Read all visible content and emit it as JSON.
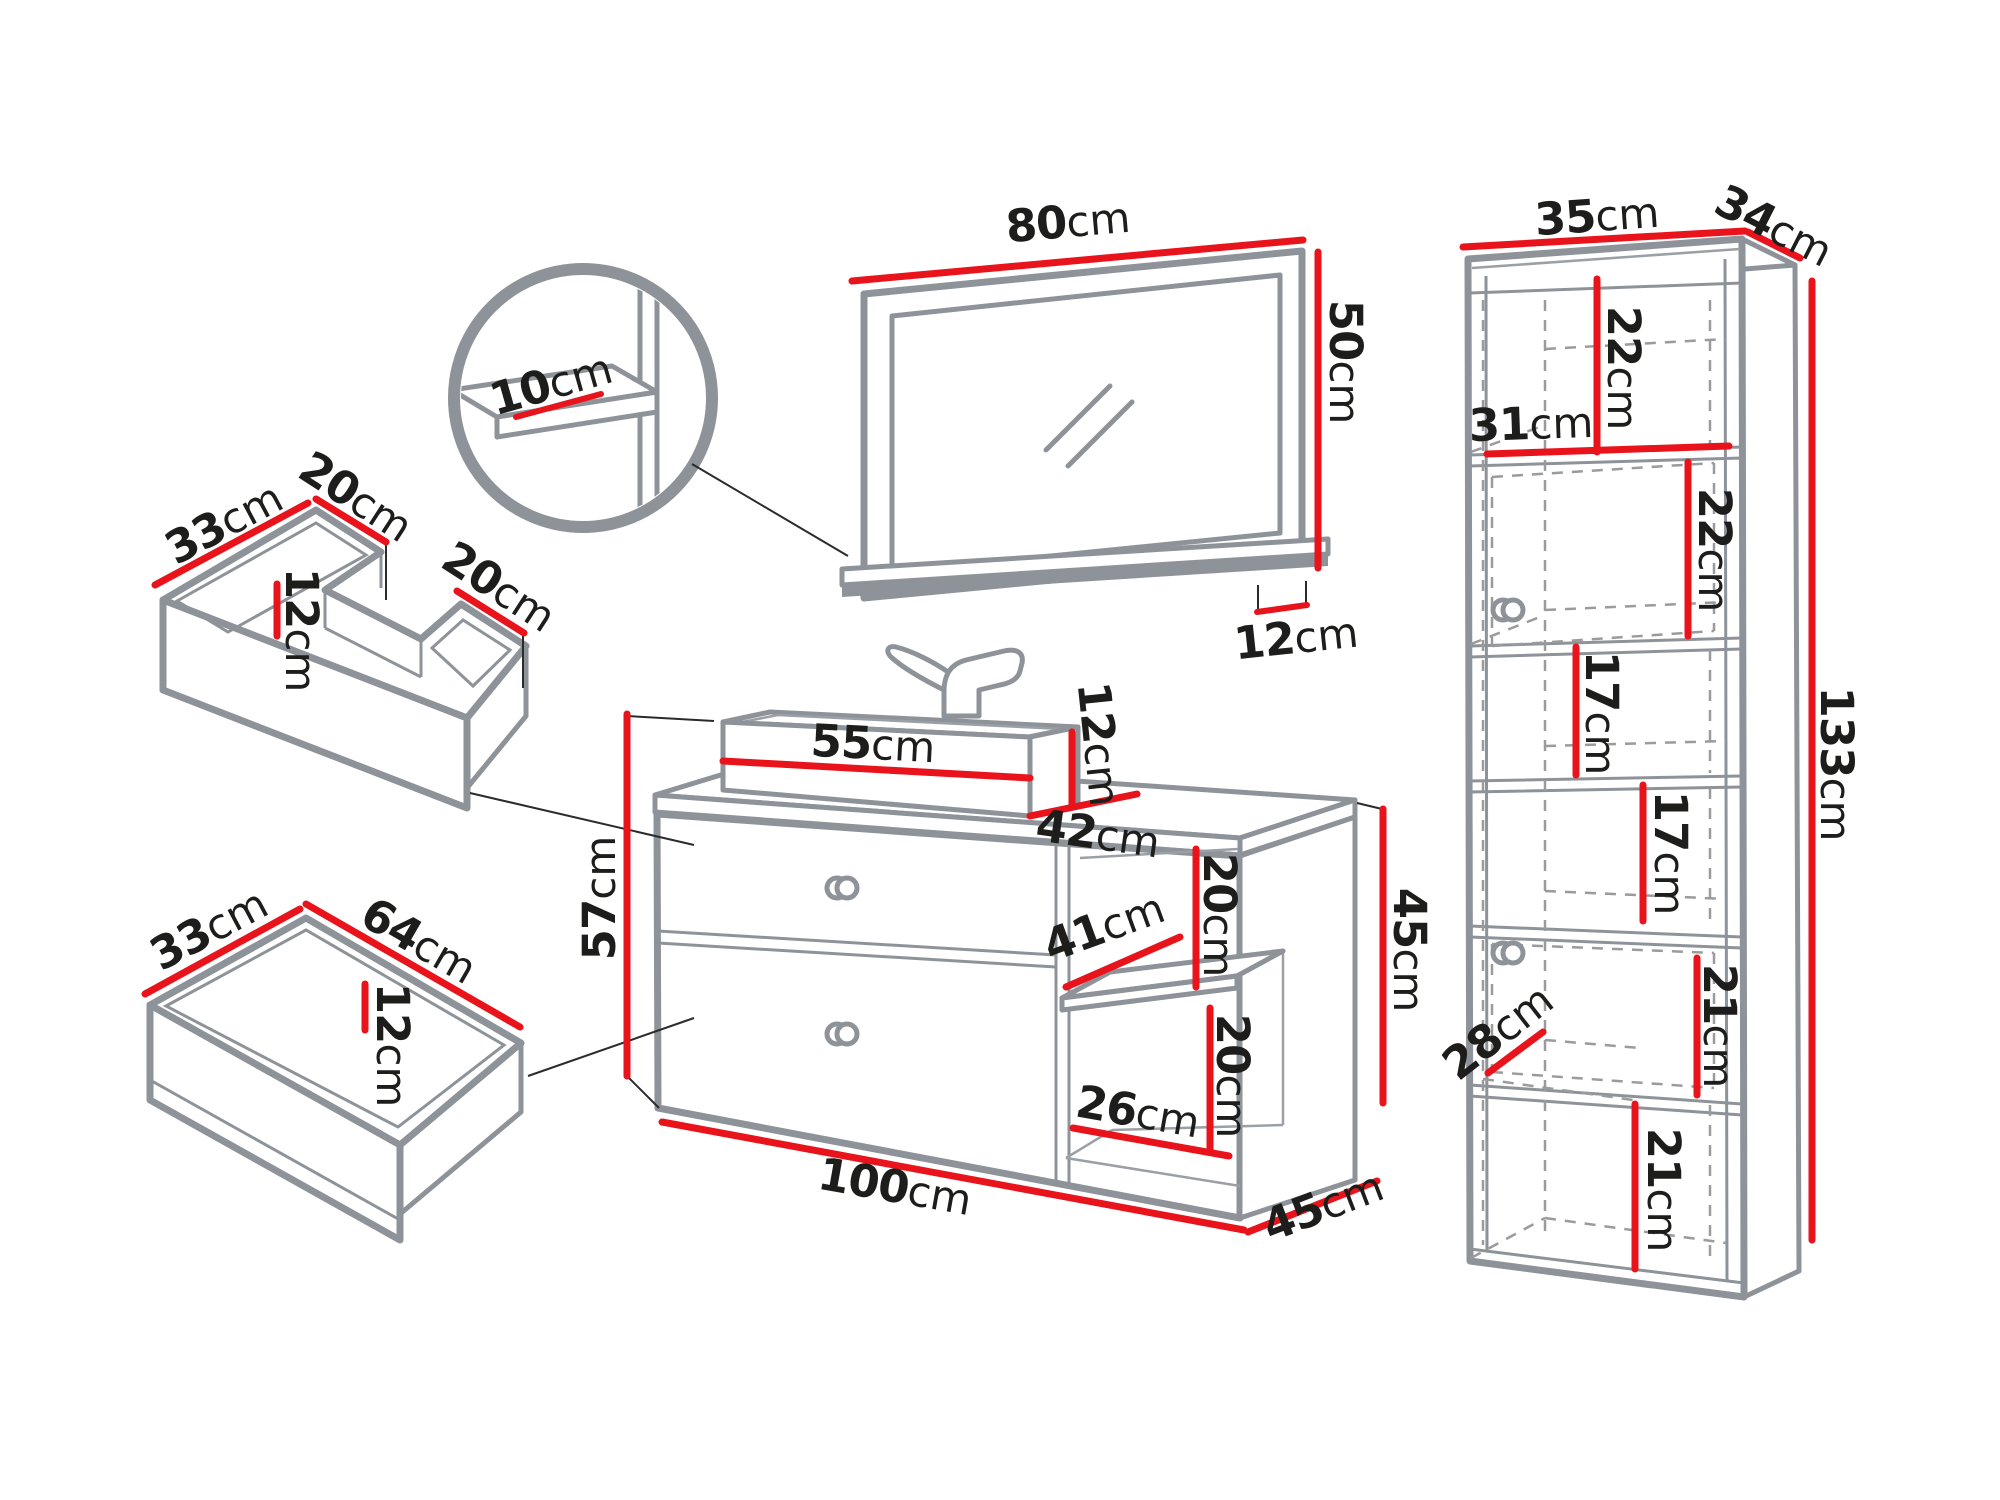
{
  "unit": "cm",
  "colors": {
    "dimension_red": "#e8131b",
    "outline_gray": "#8e9399",
    "text_black": "#1d1d1b",
    "background": "#ffffff"
  },
  "mirror": {
    "width": "80",
    "height": "50",
    "shelf_depth": "12"
  },
  "mirror_shelf_detail": {
    "shelf_front_depth": "10"
  },
  "tall_cabinet": {
    "top_width": "35",
    "top_depth": "34",
    "total_height": "133",
    "inner_width": "31",
    "inner_depth": "28",
    "sections": {
      "niche1_height": "22",
      "door1_height": "22",
      "niche2_height": "17",
      "niche3_height": "17",
      "door2_height": "21",
      "niche4_height": "21"
    }
  },
  "vanity": {
    "basin_width": "55",
    "basin_height": "12",
    "top_depth": "42",
    "front_height": "57",
    "total_width": "100",
    "total_depth": "45",
    "open_section": {
      "shelf_width": "41",
      "upper_height": "20",
      "lower_height": "20",
      "bottom_width": "26",
      "section_height": "45"
    }
  },
  "sink_drawer": {
    "depth": "33",
    "left_width": "20",
    "inner_height": "12",
    "right_width": "20"
  },
  "lower_drawer": {
    "depth": "33",
    "width": "64",
    "inner_height": "12"
  }
}
